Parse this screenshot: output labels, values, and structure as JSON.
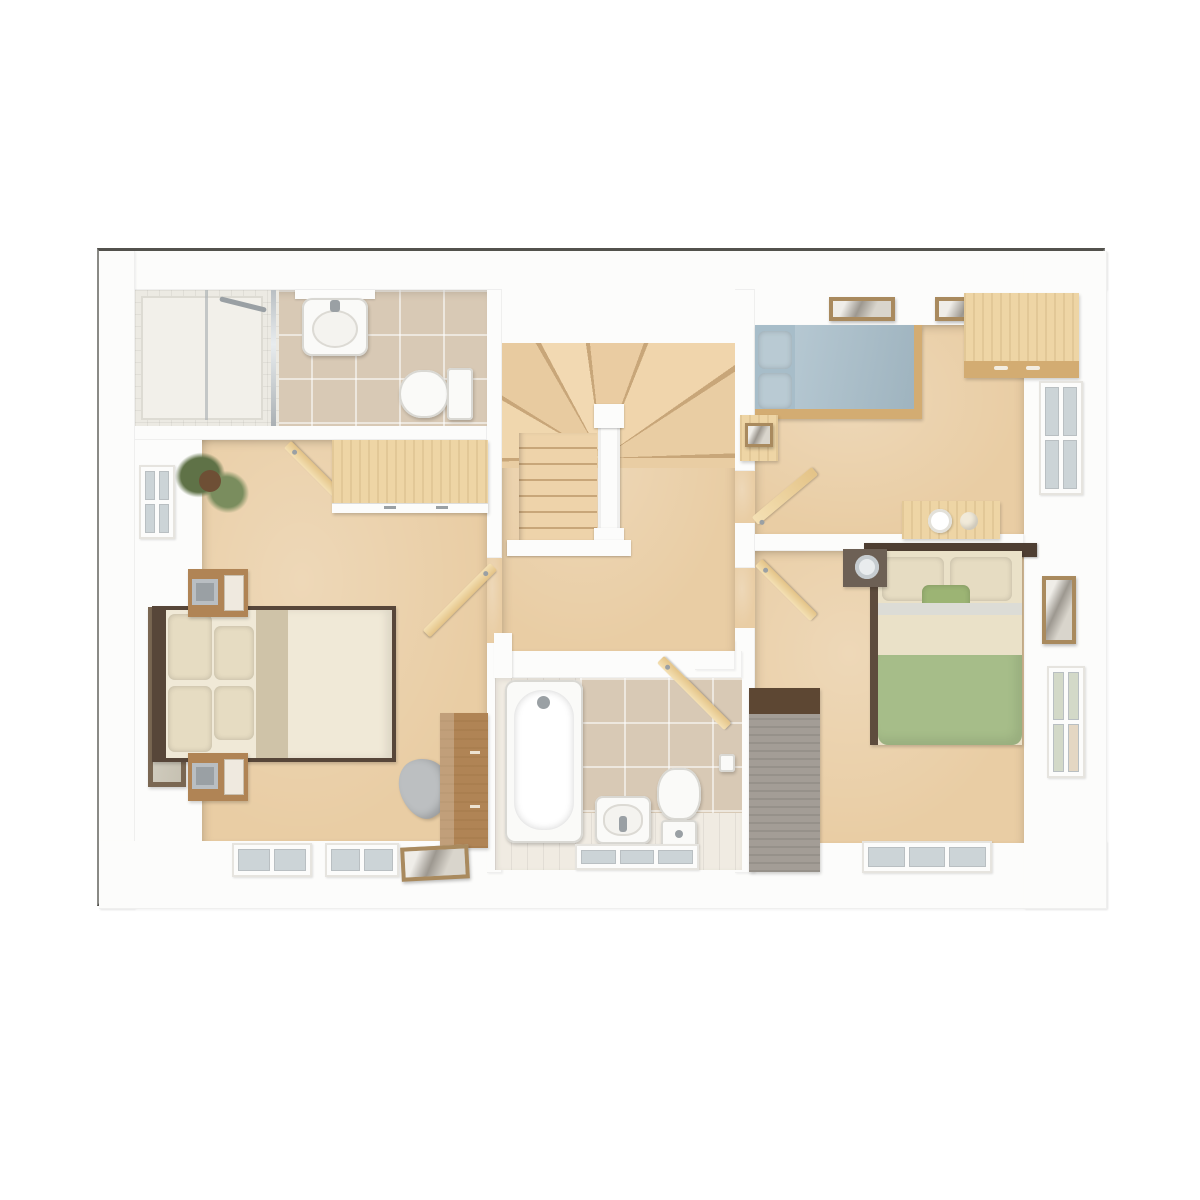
{
  "scene": {
    "kind": "3d-floor-plan-top-down-render",
    "floor": "upper-floor",
    "text_labels_visible": "none"
  },
  "colors": {
    "border": "#53524d",
    "planBg": "#f6f5f2",
    "wall": "#fcfcfb",
    "wallShade": "#e7e5e1",
    "carpet": "#e9cda4",
    "carpetLight": "#f2dcb8",
    "stairLine": "#c8a679",
    "tileWall": "#d8c9b5",
    "tileSmall": "#eceae3",
    "floorPlank": "#f0ebe2",
    "woodLight": "#eed5a5",
    "woodLightEdge": "#d3ac72",
    "woodMid": "#b08455",
    "woodDark": "#574639",
    "greyWood": "#a39d96",
    "greyWoodTop": "#5d4733",
    "fixture": "#fafaf8",
    "fixtureShade": "#d9d8d3",
    "chrome": "#9aa0a4",
    "glass": "#ccd4d7",
    "glassGreen": "#d3d9c8",
    "bedBlue": "#a7bdc9",
    "bedBluePillow": "#b9cad3",
    "bedGreen": "#a6bd89",
    "bedGreenPillow": "#9cb474",
    "bedCream": "#f0e9d7",
    "bedPillowCream": "#e6dcc2",
    "bedFold": "#cfc3a8",
    "sheetWhite": "#dcdcd6",
    "creamBand": "#eae1c8",
    "mirrorGlass": "#d0cbbd",
    "chairGrey": "#bcbfc1",
    "plantGreen": "#5f7247",
    "plantLight": "#7a8d5e",
    "potBrown": "#6e4f35",
    "artGrey": "#c4c0b8",
    "frameWood": "#a98a5e"
  },
  "rooms": [
    {
      "name": "en-suite-shower-room",
      "position": "top-left",
      "items": [
        "shower-enclosure",
        "glass-screen",
        "washbasin",
        "shelf",
        "toilet"
      ],
      "finishes": {
        "walls": "beige-tile",
        "floor": "beige-tile"
      }
    },
    {
      "name": "master-bedroom",
      "position": "bottom-left",
      "items": [
        "double-bed-cream",
        "bedside-table-with-lamp-x2",
        "leaning-wall-mirror",
        "sliding-wardrobe",
        "chest-of-drawers",
        "grey-chair",
        "potted-palm",
        "floor-picture-frame",
        "window-left-wall",
        "window-bottom-wall-x2",
        "door-to-ensuite",
        "door-to-landing"
      ],
      "finishes": {
        "floor": "beige-carpet"
      }
    },
    {
      "name": "landing-and-stairs",
      "position": "center",
      "items": [
        "winder-staircase",
        "straight-flight-down",
        "white-banister",
        "newel-posts"
      ],
      "finishes": {
        "floor": "beige-carpet"
      }
    },
    {
      "name": "family-bathroom",
      "position": "bottom-center",
      "items": [
        "bathtub",
        "washbasin",
        "toilet",
        "toilet-roll-holder",
        "door",
        "window-bottom-wall"
      ],
      "finishes": {
        "walls": "beige-tile",
        "floor": "light-plank"
      }
    },
    {
      "name": "bedroom-2",
      "position": "top-right",
      "items": [
        "single-bed-blue",
        "wardrobe-light-wood",
        "desk-with-bowl-and-plate",
        "bedside-unit",
        "wall-picture-x2",
        "window-right-wall",
        "door"
      ],
      "finishes": {
        "floor": "beige-carpet"
      }
    },
    {
      "name": "bedroom-3",
      "position": "bottom-right",
      "items": [
        "double-bed-green-cream",
        "dark-headboard",
        "bedside-table-with-glass",
        "tall-grey-wardrobe",
        "wall-picture",
        "window-right-wall",
        "window-bottom-wall",
        "door"
      ],
      "finishes": {
        "floor": "beige-carpet"
      }
    }
  ]
}
